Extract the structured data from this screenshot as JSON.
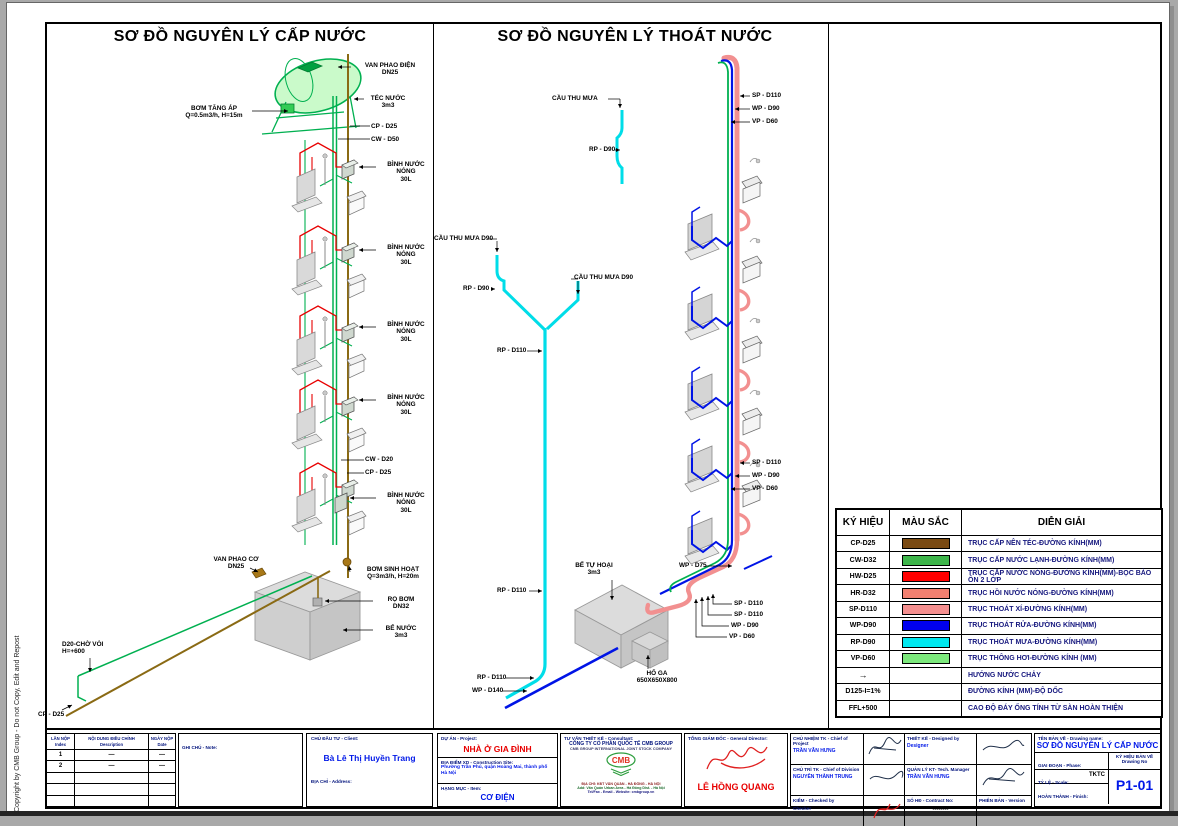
{
  "page": {
    "copyright": "Copyright by CMB Group - Do not Copy, Edit and Repost"
  },
  "panels": {
    "left": {
      "title": "SƠ ĐỒ NGUYÊN LÝ CẤP NƯỚC",
      "labels": [
        {
          "text": "VAN PHAO ĐIỆN\nDN25"
        },
        {
          "text": "TÉC NƯỚC\n3m3"
        },
        {
          "text": "BƠM TĂNG ÁP\nQ=0.5m3/h, H=15m"
        },
        {
          "text": "CP - D25"
        },
        {
          "text": "CW - D50"
        },
        {
          "text": "BÌNH NƯỚC NÓNG\n30L"
        },
        {
          "text": "BÌNH NƯỚC NÓNG\n30L"
        },
        {
          "text": "BÌNH NƯỚC NÓNG\n30L"
        },
        {
          "text": "BÌNH NƯỚC NÓNG\n30L"
        },
        {
          "text": "CW - D20"
        },
        {
          "text": "CP - D25"
        },
        {
          "text": "BÌNH NƯỚC NÓNG\n30L"
        },
        {
          "text": "VAN PHAO CƠ\nDN25"
        },
        {
          "text": "BƠM SINH HOẠT\nQ=3m3/h, H=20m"
        },
        {
          "text": "RỌ BƠM\nDN32"
        },
        {
          "text": "BỂ NƯỚC\n3m3"
        },
        {
          "text": "D20-CHỜ VÒI\nH=+600"
        },
        {
          "text": "CP - D25"
        }
      ]
    },
    "right": {
      "title": "SƠ ĐỒ NGUYÊN LÝ THOÁT NƯỚC",
      "labels": [
        {
          "text": "CẦU THU MƯA"
        },
        {
          "text": "RP - D90"
        },
        {
          "text": "SP - D110"
        },
        {
          "text": "WP - D90"
        },
        {
          "text": "VP - D60"
        },
        {
          "text": "CẦU THU MƯA D90"
        },
        {
          "text": "CẦU THU MƯA D90"
        },
        {
          "text": "RP - D90"
        },
        {
          "text": "RP - D110"
        },
        {
          "text": "SP - D110"
        },
        {
          "text": "WP - D90"
        },
        {
          "text": "VP - D60"
        },
        {
          "text": "BỂ TỰ HOẠI\n3m3"
        },
        {
          "text": "WP - D75"
        },
        {
          "text": "SP - D110"
        },
        {
          "text": "SP - D110"
        },
        {
          "text": "WP - D90"
        },
        {
          "text": "VP - D60"
        },
        {
          "text": "RP - D110"
        },
        {
          "text": "HỐ GA\n650X650X800"
        },
        {
          "text": "RP - D110"
        },
        {
          "text": "WP - D140"
        }
      ]
    }
  },
  "legend": {
    "headers": [
      "KÝ HIỆU",
      "MÀU SẮC",
      "DIỄN GIẢI"
    ],
    "rows": [
      {
        "symbol": "CP-D25",
        "color": "#7a4a12",
        "desc": "TRỤC CẤP NÊN TÉC-ĐƯỜNG KÍNH(MM)"
      },
      {
        "symbol": "CW-D32",
        "color": "#3db54a",
        "desc": "TRỤC CẤP NƯỚC LẠNH-ĐƯỜNG KÍNH(MM)"
      },
      {
        "symbol": "HW-D25",
        "color": "#ff0000",
        "desc": "TRỤC CẤP NƯỚC NÓNG-ĐƯỜNG KÍNH(MM)-BỌC BẢO ÔN 2 LỚP"
      },
      {
        "symbol": "HR-D32",
        "color": "#f28070",
        "desc": "TRỤC HỒI NƯỚC NÓNG-ĐƯỜNG KÍNH(MM)"
      },
      {
        "symbol": "SP-D110",
        "color": "#f48f8f",
        "desc": "TRỤC THOÁT XÍ-ĐƯỜNG KÍNH(MM)"
      },
      {
        "symbol": "WP-D90",
        "color": "#0000ee",
        "desc": "TRỤC THOÁT RỬA-ĐƯỜNG KÍNH(MM)"
      },
      {
        "symbol": "RP-D90",
        "color": "#00e8f0",
        "desc": "TRỤC THOÁT MƯA-ĐƯỜNG KÍNH(MM)"
      },
      {
        "symbol": "VP-D60",
        "color": "#7ce87c",
        "desc": "TRỤC THÔNG HƠI-ĐƯỜNG KÍNH (MM)"
      },
      {
        "symbol": "→",
        "color": null,
        "desc": "HƯỚNG NƯỚC CHẢY"
      },
      {
        "symbol": "D125-I=1%",
        "color": null,
        "desc": "ĐƯỜNG KÍNH (MM)-ĐỘ DỐC"
      },
      {
        "symbol": "FFL+500",
        "color": null,
        "desc": "CAO ĐỘ ĐÁY ỐNG TÍNH TỪ SÀN HOÀN THIỆN"
      }
    ]
  },
  "titleblock": {
    "revision": {
      "col1a": "LẦN NỘP",
      "col1b": "Index",
      "col2a": "NỘI DUNG ĐIỀU CHỈNH",
      "col2b": "Description",
      "col3a": "NGÀY NỘP",
      "col3b": "Date",
      "rows": [
        {
          "idx": "1",
          "desc": "—",
          "date": "—"
        },
        {
          "idx": "2",
          "desc": "—",
          "date": "—"
        }
      ]
    },
    "note_label": "GHI CHÚ - Note:",
    "client_label": "CHỦ ĐẦU TƯ - Client:",
    "client_name": "Bà Lê Thị Huyền Trang",
    "address_label": "ĐỊA CHỈ - Address:",
    "project_label": "DỰ ÁN - Project:",
    "project_name": "NHÀ Ở GIA ĐÌNH",
    "site_label": "ĐỊA ĐIỂM XD - Construction Site:",
    "site_value": "Phường Trần Phú, quận Hoàng Mai, thành phố Hà Nội",
    "item_label": "HẠNG MỤC - Item:",
    "item_value": "CƠ ĐIỆN",
    "consultant_label": "TƯ VẤN THIẾT KẾ - Consultant:",
    "consultant_name": "CÔNG TY CỔ PHẦN QUỐC TẾ CMB GROUP",
    "consultant_name_en": "CMB GROUP INTERNATIONAL JOINT STOCK COMPANY",
    "consultant_addr1": "ĐỊA CHỈ: KĐT VĂN QUÁN - HÀ ĐÔNG - HÀ NỘI",
    "consultant_addr2": "Add: Văn Quán Urban Area - Hà Đông Dist. - Hà Nội",
    "consultant_addr3": "Tel/Fax - Email - Website: cmbgroup.vn",
    "logo_text": "CMB",
    "director_label": "TỔNG GIÁM ĐỐC - General Director:",
    "director_name": "LÊ HỒNG QUANG",
    "roles": {
      "chief_project_label": "CHỦ NHIỆM TK - Chief of Project",
      "chief_project_name": "TRẦN VĂN HƯNG",
      "designed_label": "THIẾT KẾ - Designed by",
      "designed_name": "Designer",
      "chief_division_label": "CHỦ TRÌ TK - Chief of Division",
      "chief_division_name": "NGUYỄN THÀNH TRUNG",
      "tech_manager_label": "QUẢN LÝ KT- Tech. Manager",
      "tech_manager_name": "TRẦN VĂN HƯNG",
      "checked_label": "KIỂM - Checked by",
      "checked_name": "Checker",
      "contract_label": "SỐ HĐ - Contract No:",
      "contract_value": "--------",
      "version_label": "PHIÊN BẢN - Version"
    },
    "drawing": {
      "name_label": "TÊN BẢN VẼ - Drawing name:",
      "name": "SƠ ĐỒ NGUYÊN LÝ CẤP NƯỚC",
      "phase_label": "GIAI ĐOẠN - Phase:",
      "phase_value": "TKTC",
      "no_label": "KÝ HIỆU BẢN VẼ",
      "no_label_en": "Drawing No",
      "scale_label": "TỶ LỆ - Scale:",
      "finish_label": "HOÀN THÀNH - Finish:",
      "number": "P1-01"
    }
  }
}
